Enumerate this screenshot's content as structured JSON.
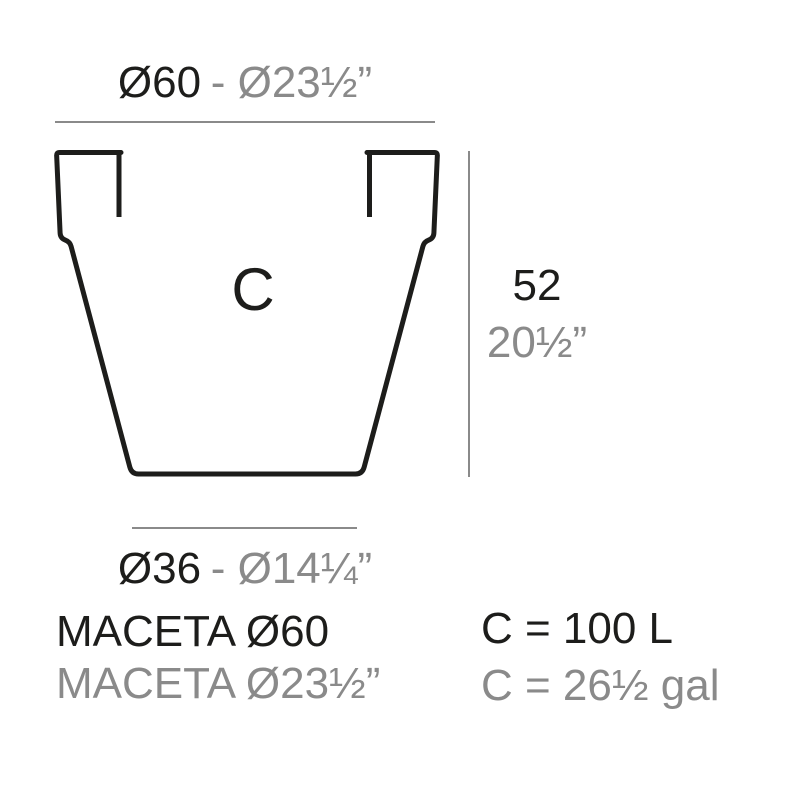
{
  "colors": {
    "ink": "#1d1d1b",
    "muted": "#8a8a8a",
    "background": "#ffffff"
  },
  "diagram": {
    "pot_label": "C",
    "top_diameter": {
      "metric": "Ø60",
      "imperial": "- Ø23½”"
    },
    "bottom_diameter": {
      "metric": "Ø36",
      "imperial": "- Ø14¼”"
    },
    "height": {
      "metric": "52",
      "imperial": "20½”"
    }
  },
  "footer": {
    "product_name_metric": "MACETA Ø60",
    "product_name_imperial": "MACETA Ø23½”",
    "capacity_metric": "C = 100 L",
    "capacity_imperial": "C = 26½ gal"
  }
}
